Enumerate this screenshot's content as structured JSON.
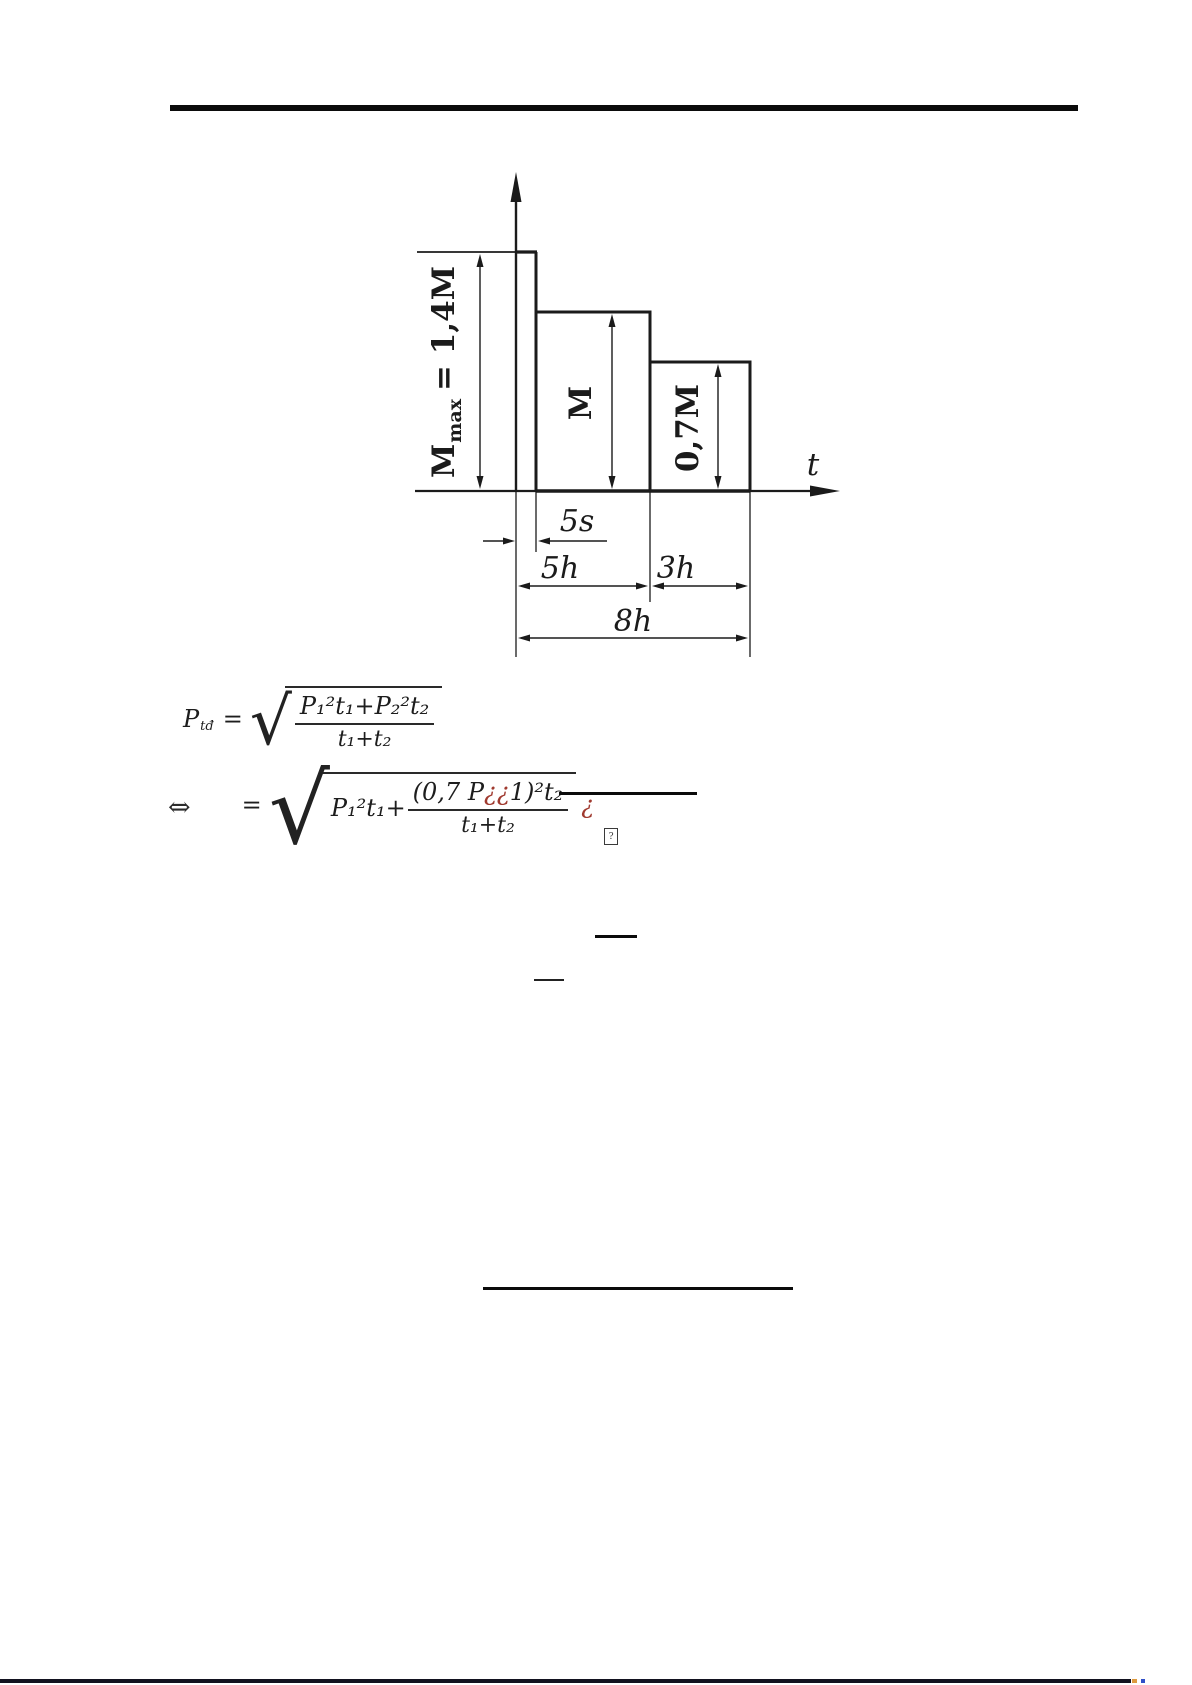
{
  "colors": {
    "ink": "#1b1b1b",
    "formula_red": "#a03a2f",
    "bottom_dot_orange": "#dd9a3f",
    "bottom_dot_blue": "#3050c8"
  },
  "figure": {
    "t_label": "t",
    "bars": {
      "mmax_main": "M",
      "mmax_sub": "max",
      "mmax_eq": "= 1,4M",
      "m": "M",
      "m07": "0,7M"
    },
    "dims": {
      "s5": "5s",
      "h5": "5h",
      "h3": "3h",
      "h8": "8h"
    }
  },
  "chart_data": {
    "type": "bar",
    "title": "",
    "xlabel": "t",
    "ylabel": "M",
    "categories": [
      "5s",
      "5h",
      "3h"
    ],
    "values": [
      1.4,
      1.0,
      0.7
    ],
    "value_labels": [
      "Mmax = 1,4M",
      "M",
      "0,7M"
    ],
    "duration_labels": [
      "5s",
      "5h",
      "3h"
    ],
    "total_duration_label": "8h",
    "ylim": [
      0,
      1.55
    ],
    "grid": false,
    "legend": false,
    "notes": "Step load-duration diagram: torque 1,4M for 5s, M for 5h, 0,7M for 3h, total 8h"
  },
  "formulas": {
    "f1": {
      "lhs": "P",
      "lhs_sub": "tđ",
      "eq": "=",
      "radical": "√",
      "num": "P₁²t₁+P₂²t₂",
      "den": "t₁+t₂"
    },
    "f2": {
      "arrow": "⇔",
      "eq": "=",
      "radical": "√",
      "pre": "P₁²t₁+",
      "num_b1": "(0,7 P",
      "num_red": "¿¿",
      "num_b2": "1)²t₂",
      "den": "t₁+t₂",
      "tail": "¿",
      "box": "?"
    }
  }
}
